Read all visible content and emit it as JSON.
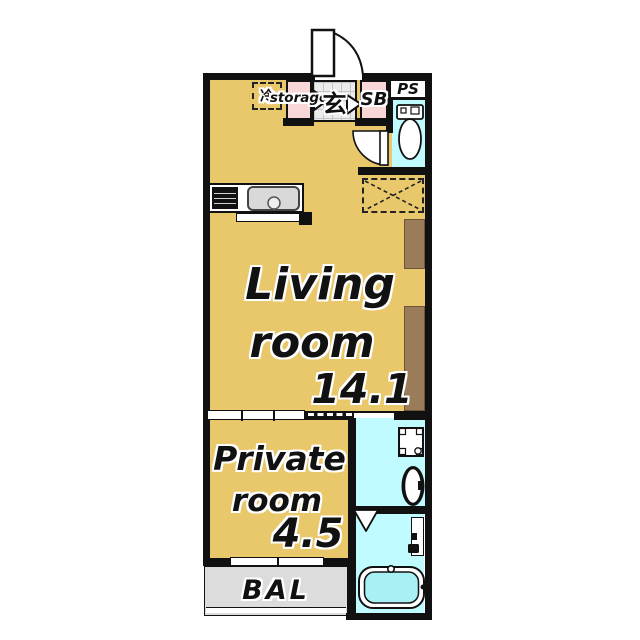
{
  "floorplan": {
    "labels": {
      "refrigerator": "冷",
      "storage": "storage",
      "entrance": "玄",
      "shoe_box": "SB",
      "pipe_space": "PS",
      "balcony": "BAL"
    },
    "rooms": {
      "living": {
        "name_line1": "Living",
        "name_line2": "room",
        "size": "14.1"
      },
      "private": {
        "name_line1": "Private",
        "name_line2": "room",
        "size": "4.5"
      }
    },
    "colors": {
      "floor_tan": "#E9C76B",
      "wet_area_cyan": "#BFFBFF",
      "closet_pink": "#F9D7D6",
      "balcony_gray": "#DCDCDC",
      "closet_brown": "#9A7C58",
      "wall_black": "#111111",
      "tile_gray": "#ECECEC"
    }
  }
}
